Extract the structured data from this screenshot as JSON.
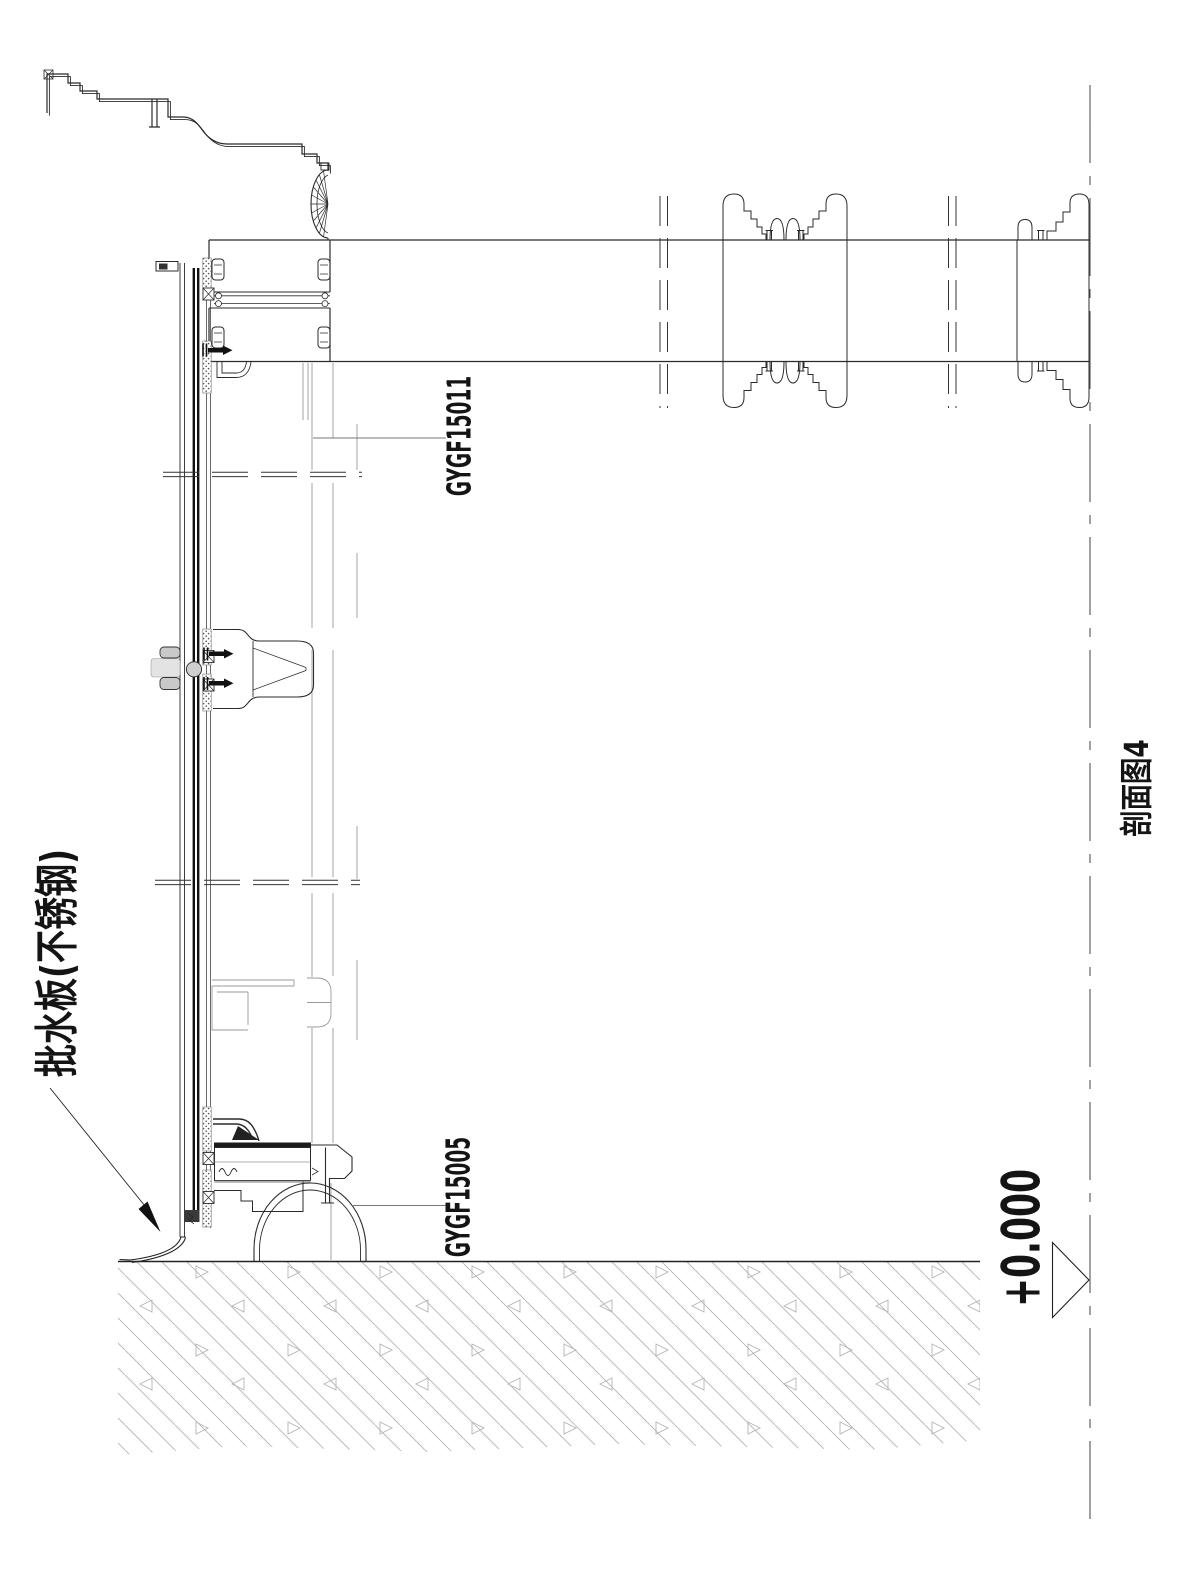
{
  "title": "剖面图4",
  "annotations": {
    "flashing": "批水板(不锈钢)",
    "profile_code_top": "GYGF15011",
    "profile_code_bottom": "GYGF15005",
    "level_mark": "+0.000"
  },
  "colors": {
    "line": "#2b2b2b",
    "faint_line": "#9a9a9a",
    "hatch": "#b4b4b4",
    "background": "#ffffff"
  }
}
